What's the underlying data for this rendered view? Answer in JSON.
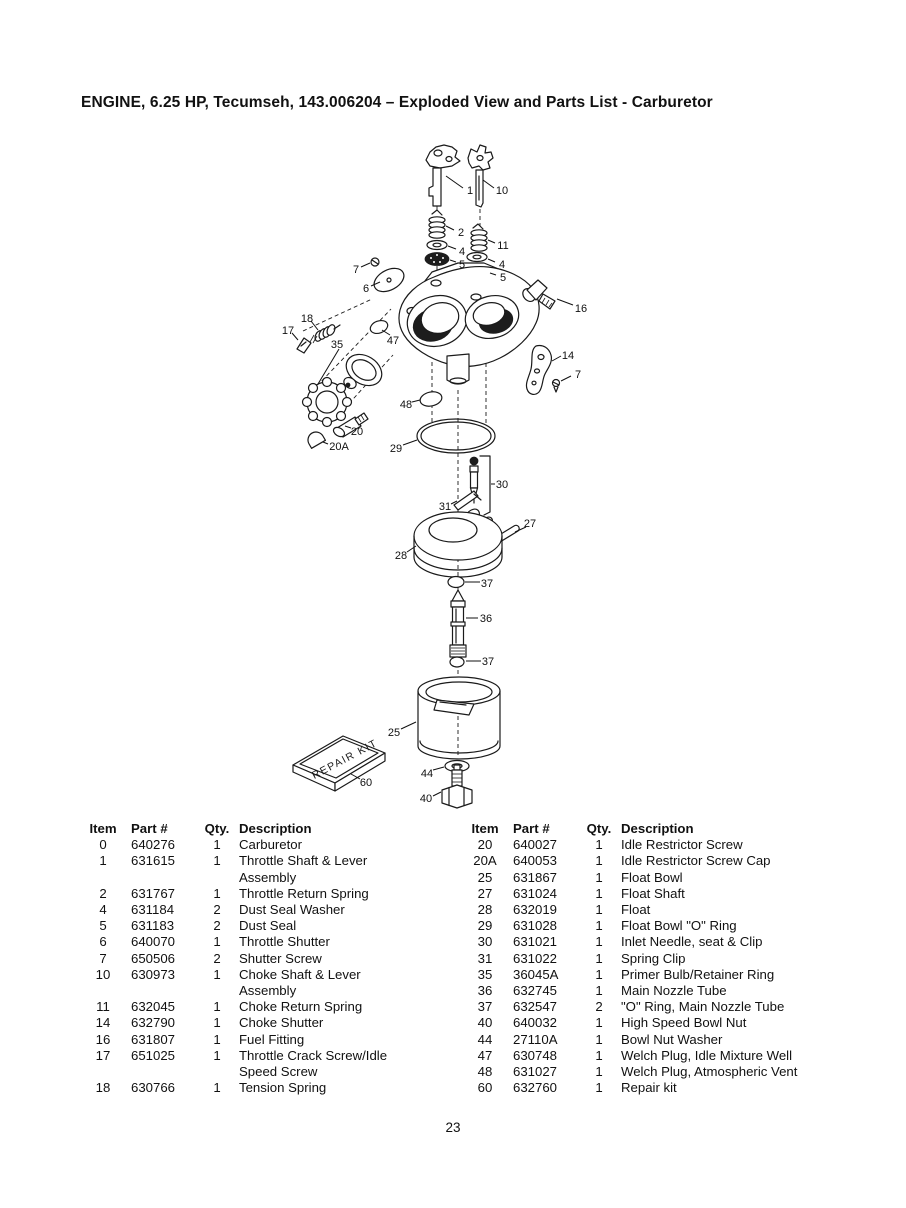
{
  "page": {
    "title": "ENGINE, 6.25 HP, Tecumseh, 143.006204 – Exploded View and Parts List - Carburetor",
    "page_number": "23"
  },
  "diagram": {
    "repair_kit_label": "REPAIR KIT",
    "callouts": [
      {
        "label": "1",
        "x": 470,
        "y": 190,
        "leader": [
          463,
          188,
          446,
          176
        ]
      },
      {
        "label": "10",
        "x": 502,
        "y": 190,
        "leader": [
          494,
          188,
          483,
          180
        ]
      },
      {
        "label": "2",
        "x": 461,
        "y": 232,
        "leader": [
          454,
          230,
          446,
          226
        ]
      },
      {
        "label": "4",
        "x": 462,
        "y": 251,
        "leader": [
          456,
          249,
          448,
          246
        ]
      },
      {
        "label": "5",
        "x": 462,
        "y": 264,
        "leader": [
          456,
          262,
          450,
          260
        ]
      },
      {
        "label": "11",
        "x": 503,
        "y": 245,
        "leader": [
          495,
          243,
          488,
          240
        ]
      },
      {
        "label": "4",
        "x": 502,
        "y": 264,
        "leader": [
          495,
          262,
          488,
          259
        ]
      },
      {
        "label": "5",
        "x": 503,
        "y": 277,
        "leader": [
          496,
          275,
          490,
          273
        ]
      },
      {
        "label": "7",
        "x": 356,
        "y": 269,
        "leader": [
          361,
          267,
          370,
          263
        ]
      },
      {
        "label": "6",
        "x": 366,
        "y": 288,
        "leader": [
          371,
          286,
          380,
          282
        ]
      },
      {
        "label": "16",
        "x": 581,
        "y": 308,
        "leader": [
          573,
          305,
          557,
          299
        ]
      },
      {
        "label": "14",
        "x": 568,
        "y": 355,
        "leader": [
          561,
          356,
          552,
          361
        ]
      },
      {
        "label": "7",
        "x": 578,
        "y": 374,
        "leader": [
          571,
          376,
          561,
          381
        ]
      },
      {
        "label": "18",
        "x": 307,
        "y": 318,
        "leader": [
          311,
          321,
          318,
          330
        ]
      },
      {
        "label": "17",
        "x": 288,
        "y": 330,
        "leader": [
          292,
          333,
          298,
          340
        ]
      },
      {
        "label": "35",
        "x": 337,
        "y": 344,
        "leader": [
          339,
          349,
          318,
          384
        ]
      },
      {
        "label": "47",
        "x": 393,
        "y": 340,
        "leader": [
          390,
          335,
          382,
          330
        ]
      },
      {
        "label": "48",
        "x": 406,
        "y": 404,
        "leader": [
          412,
          402,
          420,
          400
        ]
      },
      {
        "label": "20",
        "x": 357,
        "y": 431,
        "leader": [
          351,
          428,
          345,
          426
        ]
      },
      {
        "label": "20A",
        "x": 339,
        "y": 446,
        "leader": [
          328,
          444,
          323,
          442
        ]
      },
      {
        "label": "29",
        "x": 396,
        "y": 448,
        "leader": [
          403,
          445,
          417,
          440
        ]
      },
      {
        "label": "30",
        "x": 502,
        "y": 484,
        "leader": [
          495,
          484,
          491,
          484
        ]
      },
      {
        "label": "31",
        "x": 445,
        "y": 506,
        "leader": [
          451,
          504,
          457,
          501
        ]
      },
      {
        "label": "27",
        "x": 530,
        "y": 523,
        "leader": [
          526,
          527,
          515,
          532
        ]
      },
      {
        "label": "28",
        "x": 401,
        "y": 555,
        "leader": [
          407,
          552,
          416,
          546
        ]
      },
      {
        "label": "37",
        "x": 487,
        "y": 583,
        "leader": [
          480,
          582,
          465,
          582
        ]
      },
      {
        "label": "36",
        "x": 486,
        "y": 618,
        "leader": [
          478,
          618,
          466,
          618
        ]
      },
      {
        "label": "37",
        "x": 488,
        "y": 661,
        "leader": [
          481,
          661,
          466,
          661
        ]
      },
      {
        "label": "25",
        "x": 394,
        "y": 732,
        "leader": [
          401,
          729,
          416,
          722
        ]
      },
      {
        "label": "60",
        "x": 366,
        "y": 782,
        "leader": [
          360,
          779,
          351,
          774
        ]
      },
      {
        "label": "44",
        "x": 427,
        "y": 773,
        "leader": [
          433,
          770,
          444,
          767
        ]
      },
      {
        "label": "40",
        "x": 426,
        "y": 798,
        "leader": [
          433,
          796,
          441,
          792
        ]
      }
    ]
  },
  "parts_table": {
    "headers": {
      "item": "Item",
      "part": "Part #",
      "qty": "Qty.",
      "description": "Description"
    },
    "left_rows": [
      {
        "item": "0",
        "part": "640276",
        "qty": "1",
        "description": "Carburetor"
      },
      {
        "item": "1",
        "part": "631615",
        "qty": "1",
        "description": "Throttle Shaft & Lever\nAssembly"
      },
      {
        "item": "2",
        "part": "631767",
        "qty": "1",
        "description": "Throttle Return Spring"
      },
      {
        "item": "4",
        "part": "631184",
        "qty": "2",
        "description": "Dust Seal Washer"
      },
      {
        "item": "5",
        "part": "631183",
        "qty": "2",
        "description": "Dust Seal"
      },
      {
        "item": "6",
        "part": "640070",
        "qty": "1",
        "description": "Throttle Shutter"
      },
      {
        "item": "7",
        "part": "650506",
        "qty": "2",
        "description": "Shutter Screw"
      },
      {
        "item": "10",
        "part": "630973",
        "qty": "1",
        "description": "Choke Shaft & Lever\nAssembly"
      },
      {
        "item": "11",
        "part": "632045",
        "qty": "1",
        "description": "Choke Return Spring"
      },
      {
        "item": "14",
        "part": "632790",
        "qty": "1",
        "description": "Choke Shutter"
      },
      {
        "item": "16",
        "part": "631807",
        "qty": "1",
        "description": "Fuel Fitting"
      },
      {
        "item": "17",
        "part": "651025",
        "qty": "1",
        "description": "Throttle Crack Screw/Idle\nSpeed Screw"
      },
      {
        "item": "18",
        "part": "630766",
        "qty": "1",
        "description": "Tension Spring"
      }
    ],
    "right_rows": [
      {
        "item": "20",
        "part": "640027",
        "qty": "1",
        "description": "Idle Restrictor Screw"
      },
      {
        "item": "20A",
        "part": "640053",
        "qty": "1",
        "description": "Idle Restrictor Screw Cap"
      },
      {
        "item": "25",
        "part": "631867",
        "qty": "1",
        "description": "Float Bowl"
      },
      {
        "item": "27",
        "part": "631024",
        "qty": "1",
        "description": "Float Shaft"
      },
      {
        "item": "28",
        "part": "632019",
        "qty": "1",
        "description": "Float"
      },
      {
        "item": "29",
        "part": "631028",
        "qty": "1",
        "description": "Float Bowl \"O\" Ring"
      },
      {
        "item": "30",
        "part": "631021",
        "qty": "1",
        "description": "Inlet Needle, seat & Clip"
      },
      {
        "item": "31",
        "part": "631022",
        "qty": "1",
        "description": "Spring Clip"
      },
      {
        "item": "35",
        "part": "36045A",
        "qty": "1",
        "description": "Primer Bulb/Retainer Ring"
      },
      {
        "item": "36",
        "part": "632745",
        "qty": "1",
        "description": "Main Nozzle Tube"
      },
      {
        "item": "37",
        "part": "632547",
        "qty": "2",
        "description": "\"O\" Ring, Main Nozzle Tube"
      },
      {
        "item": "40",
        "part": "640032",
        "qty": "1",
        "description": "High Speed Bowl Nut"
      },
      {
        "item": "44",
        "part": "27110A",
        "qty": "1",
        "description": "Bowl Nut Washer"
      },
      {
        "item": "47",
        "part": "630748",
        "qty": "1",
        "description": "Welch Plug, Idle Mixture Well"
      },
      {
        "item": "48",
        "part": "631027",
        "qty": "1",
        "description": "Welch Plug, Atmospheric Vent"
      },
      {
        "item": "60",
        "part": "632760",
        "qty": "1",
        "description": "Repair kit"
      }
    ]
  }
}
